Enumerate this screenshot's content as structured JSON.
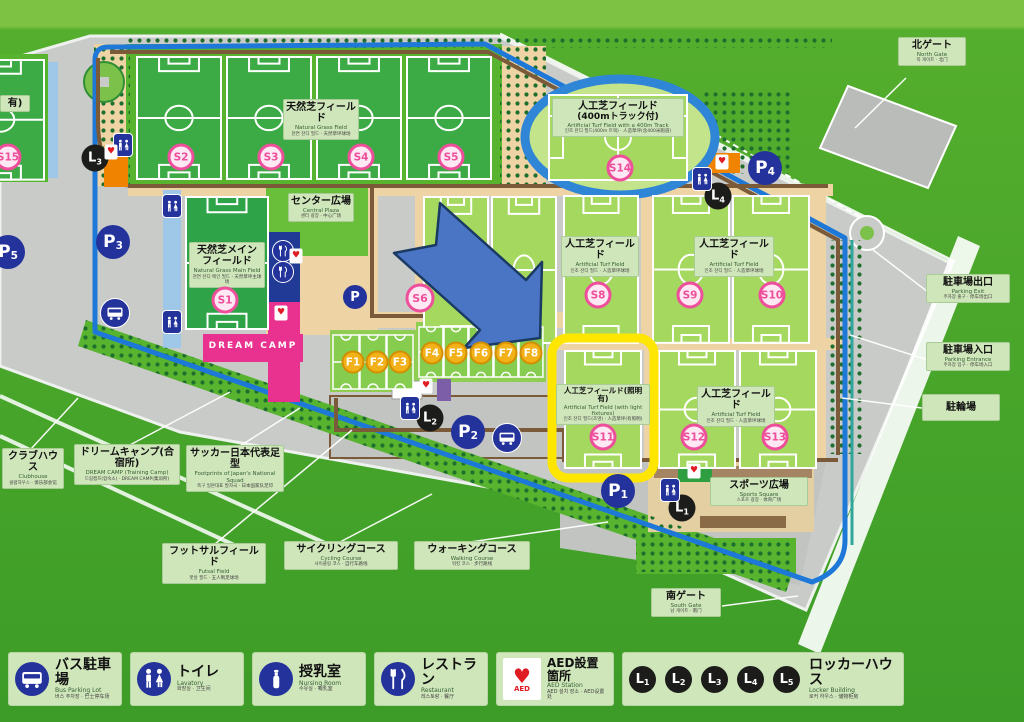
{
  "gates": {
    "north": {
      "jp": "北ゲート",
      "en": "North Gate",
      "sub": "북 게이트 · 北门"
    },
    "south": {
      "jp": "南ゲート",
      "en": "South Gate",
      "sub": "남 게이트 · 南门"
    }
  },
  "areas": {
    "natural_grass": {
      "jp": "天然芝フィールド",
      "en": "Natural Grass Field",
      "sub": "천연 잔디 필드 · 天然草坪球场"
    },
    "track": {
      "jp1": "人工芝フィールド",
      "jp2": "(400mトラック付)",
      "en": "Artificial Turf Field with a 400m Track",
      "sub": "인조 잔디 필드(400m 트랙) · 人造草坪(含400米跑道)"
    },
    "main": {
      "jp1": "天然芝メイン",
      "jp2": "フィールド",
      "en": "Natural Grass Main Field",
      "sub": "천연 잔디 메인 필드 · 天然草坪主球场"
    },
    "center_plaza": {
      "jp": "センター広場",
      "en": "Central Plaza",
      "sub": "센터 광장 · 中心广场"
    },
    "turf": {
      "jp": "人工芝フィールド",
      "en": "Artificial Turf Field",
      "sub": "인조 잔디 필드 · 人造草坪球场"
    },
    "turf_light": {
      "jp": "人工芝フィールド(照明有)",
      "en": "Artificial Turf Field (with light fixtures)",
      "sub": "인조 잔디 필드(조명) · 人造草坪(有照明)"
    },
    "sports_square": {
      "jp": "スポーツ広場",
      "en": "Sports Square",
      "sub": "스포츠 광장 · 体育广场"
    },
    "s15_partial": {
      "jp": "有)"
    }
  },
  "callouts": {
    "parking_exit": {
      "jp": "駐車場出口",
      "en": "Parking Exit",
      "sub": "주차장 출구 · 停车场出口"
    },
    "parking_entrance": {
      "jp": "駐車場入口",
      "en": "Parking Entrance",
      "sub": "주차장 입구 · 停车场入口"
    },
    "bicycle": {
      "jp": "駐輪場"
    },
    "clubhouse": {
      "jp": "クラブハウス",
      "en": "Clubhouse",
      "sub": "클럽하우스 · 俱乐部会馆"
    },
    "dream_camp": {
      "jp": "ドリームキャンプ(合宿所)",
      "en": "DREAM CAMP (Training Camp)",
      "sub": "드림캠프(합숙소) · DREAM CAMP(集训所)"
    },
    "footprints": {
      "jp": "サッカー日本代表足型",
      "en": "Footprints of Japan's National Squad",
      "sub": "축구 일본대표 발자국 · 日本国家队足印"
    },
    "futsal": {
      "jp": "フットサルフィールド",
      "en": "Futsal Field",
      "sub": "풋살 필드 · 五人制足球场"
    },
    "cycling": {
      "jp": "サイクリングコース",
      "en": "Cycling Course",
      "sub": "사이클링 코스 · 自行车路线"
    },
    "walking": {
      "jp": "ウォーキングコース",
      "en": "Walking Course",
      "sub": "워킹 코스 · 步行路线"
    }
  },
  "buildings": {
    "dream_camp_sign": "DREAM CAMP"
  },
  "icons": {
    "heart": "♥"
  },
  "mk": {
    "s1": "S1",
    "s2": "S2",
    "s3": "S3",
    "s4": "S4",
    "s5": "S5",
    "s6": "S6",
    "s8": "S8",
    "s9": "S9",
    "s10": "S10",
    "s11": "S11",
    "s12": "S12",
    "s13": "S13",
    "s14": "S14",
    "s15": "S15",
    "f1": "F1",
    "f2": "F2",
    "f3": "F3",
    "f4": "F4",
    "f5": "F5",
    "f6": "F6",
    "f7": "F7",
    "f8": "F8",
    "p0": "P",
    "p1": {
      "t": "P",
      "n": "1"
    },
    "p2": {
      "t": "P",
      "n": "2"
    },
    "p3": {
      "t": "P",
      "n": "3"
    },
    "p4": {
      "t": "P",
      "n": "4"
    },
    "p5": {
      "t": "P",
      "n": "5"
    },
    "l1": {
      "t": "L",
      "n": "1"
    },
    "l2": {
      "t": "L",
      "n": "2"
    },
    "l3": {
      "t": "L",
      "n": "3"
    },
    "l4": {
      "t": "L",
      "n": "4"
    }
  },
  "legend": {
    "bus": {
      "jp": "バス駐車場",
      "en": "Bus Parking Lot",
      "sub": "버스 주차장 · 巴士停车场"
    },
    "lavatory": {
      "jp": "トイレ",
      "en": "Lavatory",
      "sub": "화장실 · 卫生间"
    },
    "nursing": {
      "jp": "授乳室",
      "en": "Nursing Room",
      "sub": "수유실 · 哺乳室"
    },
    "restaurant": {
      "jp": "レストラン",
      "en": "Restaurant",
      "sub": "레스토랑 · 餐厅"
    },
    "aed": {
      "jp": "AED設置箇所",
      "en": "AED Station",
      "sub": "AED 설치 장소 · AED设置处",
      "icon_text": "AED"
    },
    "locker": {
      "jp": "ロッカーハウス",
      "en": "Locker Building",
      "sub": "로커 하우스 · 储物柜房",
      "items": [
        {
          "t": "L",
          "n": "1"
        },
        {
          "t": "L",
          "n": "2"
        },
        {
          "t": "L",
          "n": "3"
        },
        {
          "t": "L",
          "n": "4"
        },
        {
          "t": "L",
          "n": "5"
        }
      ]
    }
  }
}
